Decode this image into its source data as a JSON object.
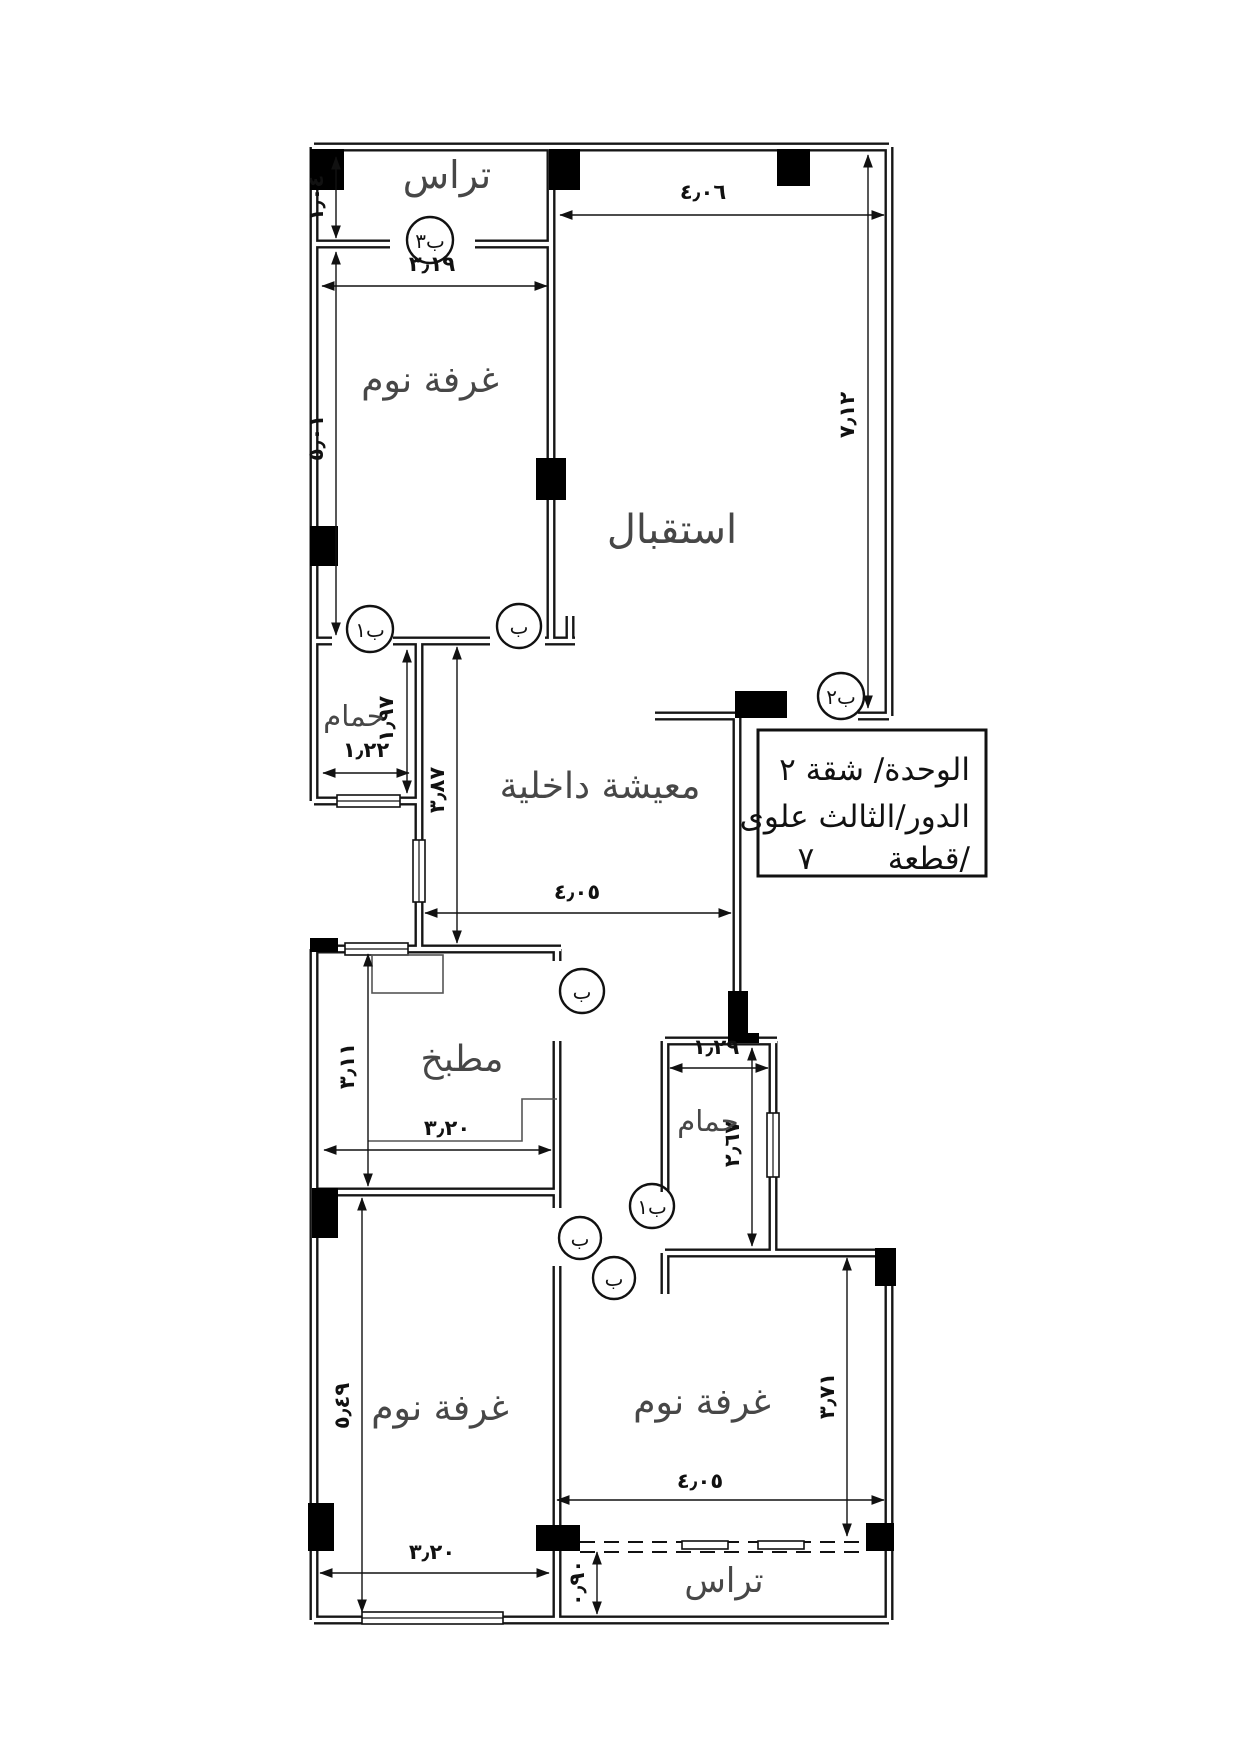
{
  "title_block": {
    "line1": "الوحدة/  شقة ٢",
    "line2": "الدور/الثالث علوى",
    "line3_label": "قطعة/",
    "line3_value": "٧"
  },
  "rooms": {
    "terrace_top": "تراس",
    "bedroom_top": "غرفة نوم",
    "reception": "استقبال",
    "bathroom_1": "حمام",
    "living": "معيشة داخلية",
    "kitchen": "مطبخ",
    "bathroom_2": "حمام",
    "bedroom_bottom_left": "غرفة نوم",
    "bedroom_bottom_right": "غرفة نوم",
    "terrace_bottom": "تراس"
  },
  "doors": {
    "terrace_door": "ب٣",
    "bathroom1_door": "ب١",
    "bedroom_top_door": "ب",
    "entrance_door": "ب٢",
    "kitchen_door": "ب",
    "bathroom2_door": "ب١",
    "bedroom_bl_door": "ب",
    "bedroom_br_door": "ب"
  },
  "dimensions": {
    "terrace_depth": "١٫٠٤",
    "terrace_width": "٣٫١٩",
    "reception_width": "٤٫٠٦",
    "bedroom_top_height": "٥٫٠١",
    "reception_height": "٧٫١٢",
    "bathroom1_height": "١٫٩٧",
    "bathroom1_width": "١٫٢٢",
    "living_height": "٣٫٨٧",
    "living_width": "٤٫٠٥",
    "kitchen_height": "٣٫١١",
    "kitchen_width": "٣٫٢٠",
    "bathroom2_width": "١٫٢٩",
    "bathroom2_height": "٢٫٦٧",
    "bedroom_bl_height": "٥٫٤٩",
    "bedroom_bl_width": "٣٫٢٠",
    "bedroom_br_height": "٣٫٧١",
    "bedroom_br_width": "٤٫٠٥",
    "terrace_bottom_depth": "٠٫٩٠"
  }
}
